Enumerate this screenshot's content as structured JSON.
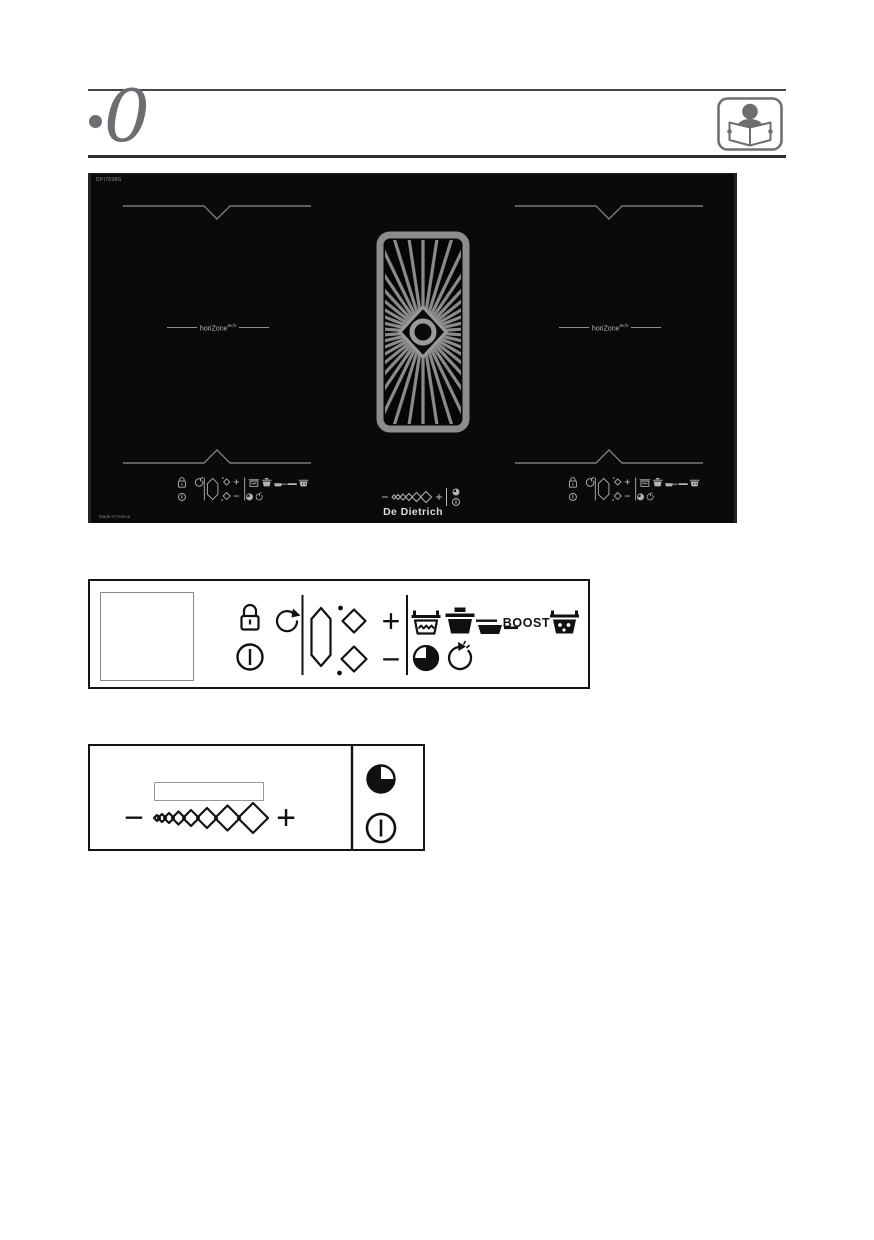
{
  "colors": {
    "page_bg": "#ffffff",
    "cooktop_bg": "#0a0a0a",
    "panel_icon_gray": "#b5b5b5",
    "line_gray": "#8f8f8f",
    "header_gray": "#6b6e72",
    "diagram_ink": "#111111"
  },
  "header": {
    "bullet": "•",
    "section_number": "0",
    "manual_icon": "person-reading-manual-icon"
  },
  "cooktop": {
    "model_text": "DPI7698G",
    "made_in_text": "Made in France",
    "zone_label": "horiZone",
    "zone_label_sup": "tech",
    "brand": "De Dietrich",
    "icons": [
      "zone-marker",
      "extractor-grille",
      "lock-icon",
      "rotate-icon",
      "power-icon",
      "digit-display-icon",
      "diamond-icon",
      "plus-icon",
      "minus-icon",
      "pot-icons",
      "timer-icons",
      "power-slider-diamonds"
    ]
  },
  "panel_diagram": {
    "plus": "+",
    "minus": "−",
    "boost": "BOOST",
    "icons": [
      "lock-icon",
      "rotate-icon",
      "power-icon",
      "digit-display-icon",
      "diamond-up-icon",
      "diamond-down-icon",
      "boil-pot-icon",
      "stew-pot-icon",
      "frying-pan-icon",
      "keep-warm-pot-icon",
      "timer-pie-icon",
      "timer-elapsed-icon"
    ]
  },
  "slider_diagram": {
    "plus": "+",
    "minus": "−",
    "icons": [
      "power-slider-diamonds",
      "timer-pie-icon",
      "power-icon"
    ]
  }
}
